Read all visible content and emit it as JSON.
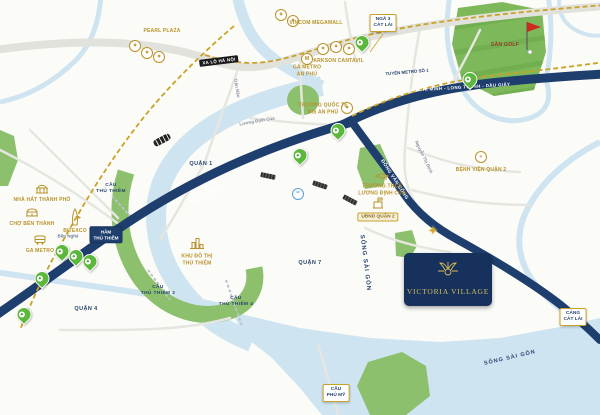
{
  "project": {
    "name": "VICTORIA VILLAGE"
  },
  "colors": {
    "water": "#cfe4f1",
    "green": "#8cc06c",
    "navy_road": "#1e3f6e",
    "gold": "#c9a227",
    "pin_green": "#5cb83c",
    "card_bg": "#16325c",
    "card_gold": "#d9b95c"
  },
  "districts": {
    "quan_1": "QUẬN 1",
    "quan_4": "QUẬN 4",
    "quan_7": "QUẬN 7",
    "ben_nghe": "Bến Nghé"
  },
  "rivers": {
    "saigon_mid": "SÔNG SÀI GÒN",
    "saigon_bottom": "SÔNG SÀI GÒN"
  },
  "roads": {
    "xa_lo_ha_noi": "XA LỘ HÀ NỘI",
    "cao_toc": "CAO TỐC HỒ CHÍ MINH - LONG THÀNH - DẦU GIÂY",
    "mai_chi_tho": "MAI CHÍ THỌ",
    "dong_van_cong": "ĐỒNG VĂN CỐNG",
    "nguyen_thi_dinh": "Nguyễn Thị Định",
    "luong_dinh_cua": "Lương Định Của",
    "tran_nao": "Trần Não",
    "metro_line": "TUYẾN METRO SỐ 1"
  },
  "boxes": {
    "nga3_cat_lai": {
      "line1": "NGÃ 3",
      "line2": "CÁT LÁI"
    },
    "cang_cat_lai": {
      "line1": "CẢNG",
      "line2": "CÁT LÁI"
    },
    "cau_phu_my": {
      "line1": "CẦU",
      "line2": "PHÚ MỸ"
    },
    "ham_thu_thiem": {
      "line1": "HẦM",
      "line2": "THỦ THIÊM"
    }
  },
  "bridges": {
    "cau_thu_thiem": {
      "line1": "CẦU",
      "line2": "THỦ THIÊM"
    },
    "cau_thu_thiem_2": {
      "line1": "CẦU",
      "line2": "THỦ THIÊM 2"
    },
    "cau_thu_thiem_4": {
      "line1": "CẦU",
      "line2": "THỦ THIÊM 4"
    }
  },
  "landmarks": {
    "pearl_plaza": "PEARL PLAZA",
    "vincom_megamall": "VINCOM MEGAMALL",
    "parkson_cantavil": "PARKSON CANTAVIL",
    "ga_metro_an_phu": {
      "line1": "GA METRO",
      "line2": "AN PHÚ"
    },
    "truong_quoc_te": {
      "line1": "TRƯỜNG QUỐC TẾ",
      "line2": "BIS AN PHÚ"
    },
    "truong_thcs": {
      "line1": "TRƯỜNG THCS",
      "line2": "LƯƠNG ĐỊNH CỦA"
    },
    "ubnd_quan_2": "UBND QUẬN 2",
    "benh_vien": "BỆNH VIỆN QUẬN 2",
    "khu_do_thi": {
      "line1": "KHU ĐÔ THỊ",
      "line2": "THỦ THIÊM"
    },
    "nha_hat": "NHÀ HÁT THÀNH PHỐ",
    "cho_ben_thanh": "CHỢ BẾN THÀNH",
    "ga_metro": "GA METRO",
    "bitexco": "BITEXCO",
    "san_golf": "SÂN GOLF"
  }
}
